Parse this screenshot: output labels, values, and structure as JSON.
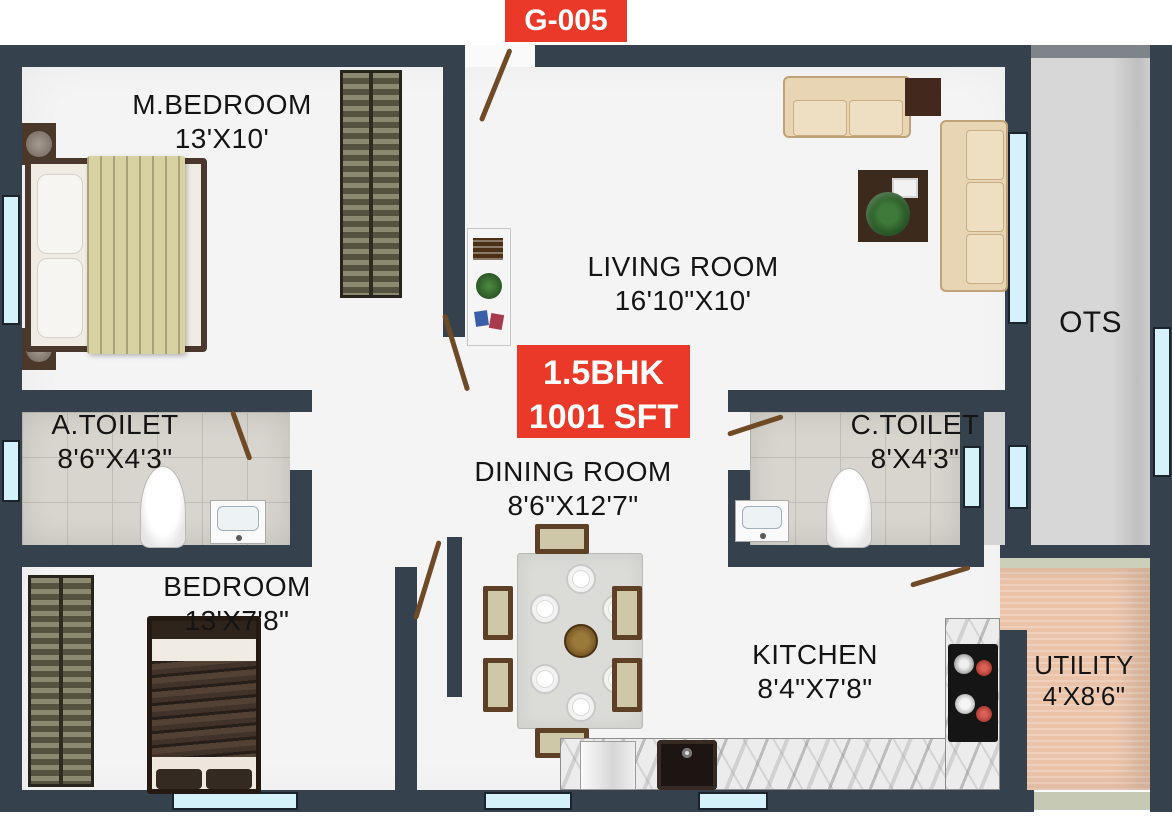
{
  "badge": {
    "label": "G-005"
  },
  "unit": {
    "type": "1.5BHK",
    "area": "1001 SFT"
  },
  "rooms": [
    {
      "name": "M.BEDROOM",
      "dims": "13'X10'"
    },
    {
      "name": "LIVING ROOM",
      "dims": "16'10\"X10'"
    },
    {
      "name": "A.TOILET",
      "dims": "8'6\"X4'3\""
    },
    {
      "name": "DINING ROOM",
      "dims": "8'6\"X12'7\""
    },
    {
      "name": "C.TOILET",
      "dims": "8'X4'3\""
    },
    {
      "name": "BEDROOM",
      "dims": "13'X7'8\""
    },
    {
      "name": "KITCHEN",
      "dims": "8'4\"X7'8\""
    },
    {
      "name": "UTILITY",
      "dims": "4'X8'6\""
    },
    {
      "name": "OTS",
      "dims": ""
    }
  ],
  "colors": {
    "accent_red": "#EA3829",
    "wall": "#36414E",
    "window": "#D5F1FA",
    "ots_floor": "#D6D6D6",
    "utility_floor": "#EAC3A9",
    "tile_floor": "#D8D5CE"
  }
}
